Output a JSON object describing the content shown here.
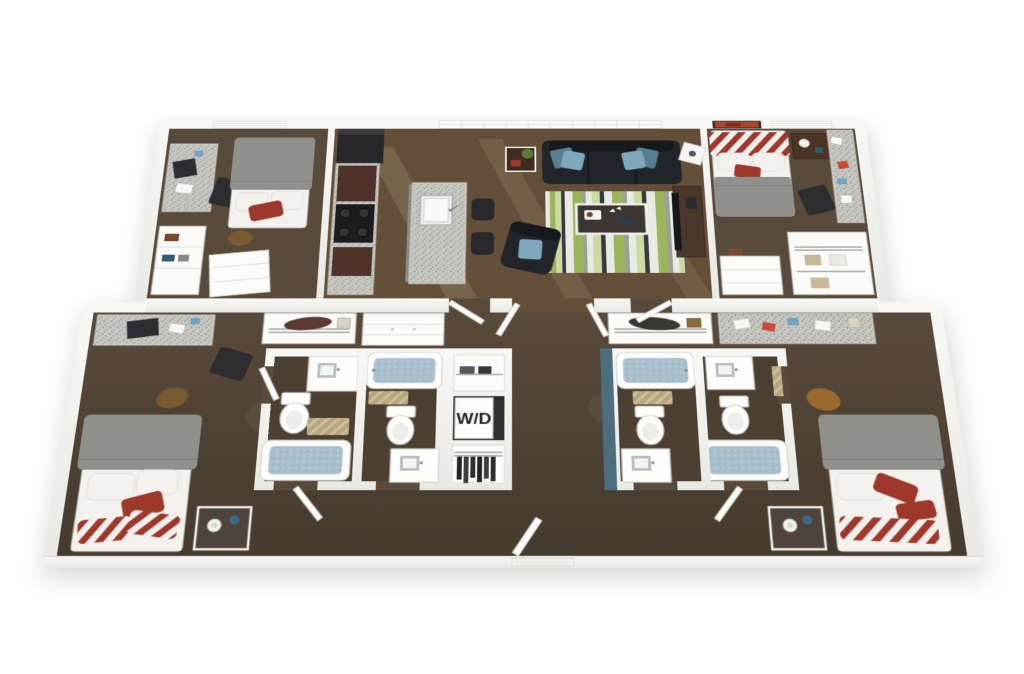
{
  "scene": {
    "type": "3d-apartment-floor-plan-rendering",
    "labels": {
      "washer_dryer": "W/D"
    },
    "colors": {
      "wall": "#f3f3f1",
      "wallShade": "#dcdcd8",
      "carpet": "#594b3c",
      "carpetDark": "#4c4032",
      "wood": "#64503a",
      "teal": "#4d6e7e",
      "bedWhite": "#f2f1ed",
      "bedGray": "#8f8f8c",
      "red": "#9e382c",
      "sofa": "#22252a",
      "sofaDark": "#17191d",
      "pillowBlue": "#7fa8bc",
      "pillowBlueDark": "#587e91",
      "appliance": "#28282c",
      "cabinet": "#4f332a",
      "woodDark": "#5b3f2e",
      "granite": "#c6c6c1",
      "graniteDot": "#8e8e88",
      "water": "#a7bfca",
      "tan": "#b7a67f",
      "door": "#fbfbf9",
      "wire": "#9a9a96",
      "rugWhite": "#e9e9e4",
      "rugGreen": "#9cb45c",
      "rugLight": "#cdd9a2",
      "rugGray": "#9aa098",
      "rugDark": "#343a3e"
    },
    "rooms": [
      {
        "name": "bedroom-top-left",
        "furniture": [
          "bed",
          "desk",
          "desk-chair",
          "shelf-closet",
          "dresser",
          "ceiling-light"
        ]
      },
      {
        "name": "kitchen",
        "furniture": [
          "refrigerator",
          "stove",
          "counter",
          "island-with-sink",
          "bar-stools"
        ]
      },
      {
        "name": "living-room",
        "furniture": [
          "sofa",
          "area-rug",
          "coffee-table",
          "armchair",
          "side-table",
          "cube-table",
          "media-console",
          "window-band"
        ]
      },
      {
        "name": "bedroom-top-right",
        "furniture": [
          "bed",
          "nightstand",
          "desk",
          "desk-chair",
          "closet",
          "dresser",
          "wall-art",
          "ceiling-light"
        ]
      },
      {
        "name": "bedroom-bottom-left",
        "furniture": [
          "bed",
          "nightstand",
          "desk",
          "desk-chair",
          "wire-closet",
          "dresser",
          "backpack"
        ]
      },
      {
        "name": "bathroom-left-front",
        "furniture": [
          "bathtub",
          "toilet",
          "vanity",
          "bath-mat"
        ]
      },
      {
        "name": "bathroom-left-back",
        "furniture": [
          "bathtub",
          "toilet",
          "vanity",
          "bath-mat"
        ]
      },
      {
        "name": "laundry-closet",
        "furniture": [
          "washer-dryer",
          "shelf-closet",
          "wardrobe"
        ]
      },
      {
        "name": "bathroom-right-back",
        "furniture": [
          "bathtub",
          "toilet",
          "vanity",
          "bath-mat"
        ]
      },
      {
        "name": "bathroom-right-front",
        "furniture": [
          "bathtub",
          "toilet",
          "vanity",
          "towel"
        ]
      },
      {
        "name": "bedroom-bottom-right",
        "furniture": [
          "bed",
          "nightstand",
          "desk",
          "desk-chair",
          "wire-closet",
          "backpack"
        ]
      }
    ]
  }
}
